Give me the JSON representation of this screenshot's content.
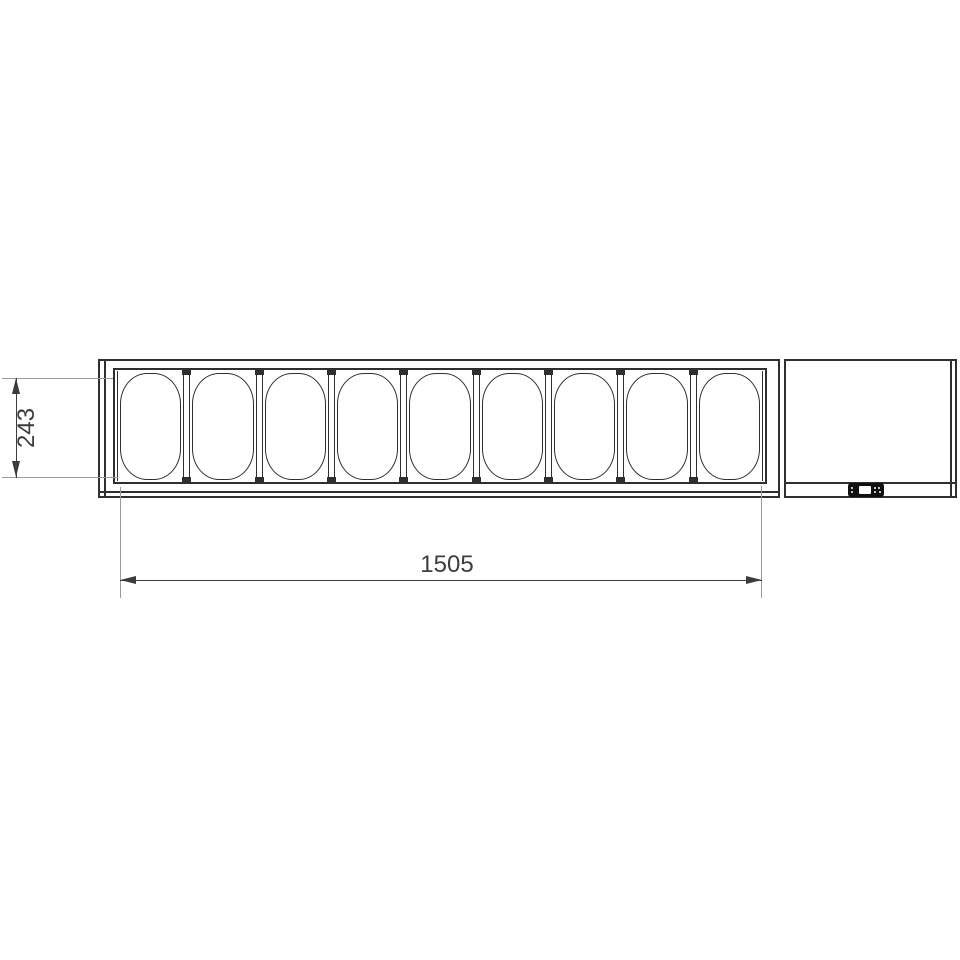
{
  "unit": {
    "pan_count": 9
  },
  "dimensions": {
    "depth": {
      "label": "243"
    },
    "width": {
      "label": "1505"
    }
  },
  "icons": {
    "control_panel": "digital-controller-icon",
    "dimension_arrows": [
      "arrow-up-icon",
      "arrow-down-icon",
      "arrow-left-icon",
      "arrow-right-icon"
    ]
  },
  "colors": {
    "line": "#2f2f2f",
    "ext": "#9b9b9b",
    "dim": "#3c3c3c",
    "text": "#3d3d3d",
    "panel": "#101010",
    "display": "#ffffff",
    "bg": "#ffffff"
  }
}
